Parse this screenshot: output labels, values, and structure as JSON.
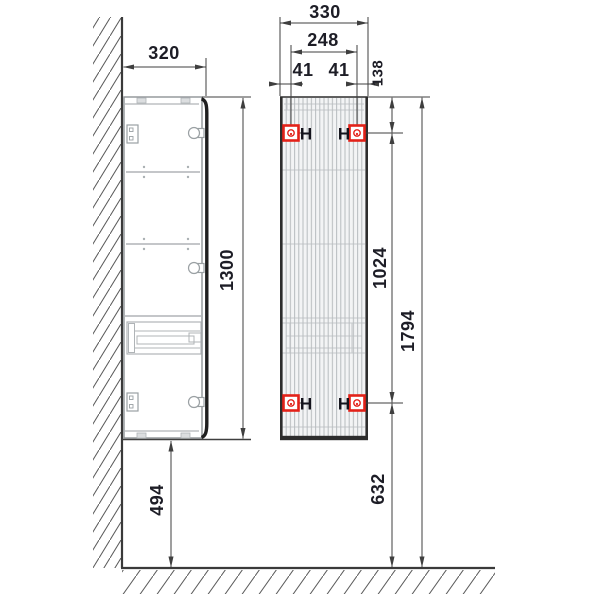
{
  "labels": {
    "depth": "320",
    "width": "330",
    "hole_spacing_horizontal": "248",
    "hole_offset_left": "41",
    "hole_offset_right": "41",
    "top_to_hole": "138",
    "cabinet_height": "1300",
    "hole_spacing_vertical": "1024",
    "overall_height": "1794",
    "floor_clearance": "494",
    "floor_to_bottom_hole": "632",
    "hanger_mark": "H"
  },
  "colors": {
    "line": "#3f3f3f",
    "light_gray": "#b4b8bb",
    "bracket_red": "#e32219",
    "text": "#1d1d26",
    "background": "#ffffff"
  }
}
